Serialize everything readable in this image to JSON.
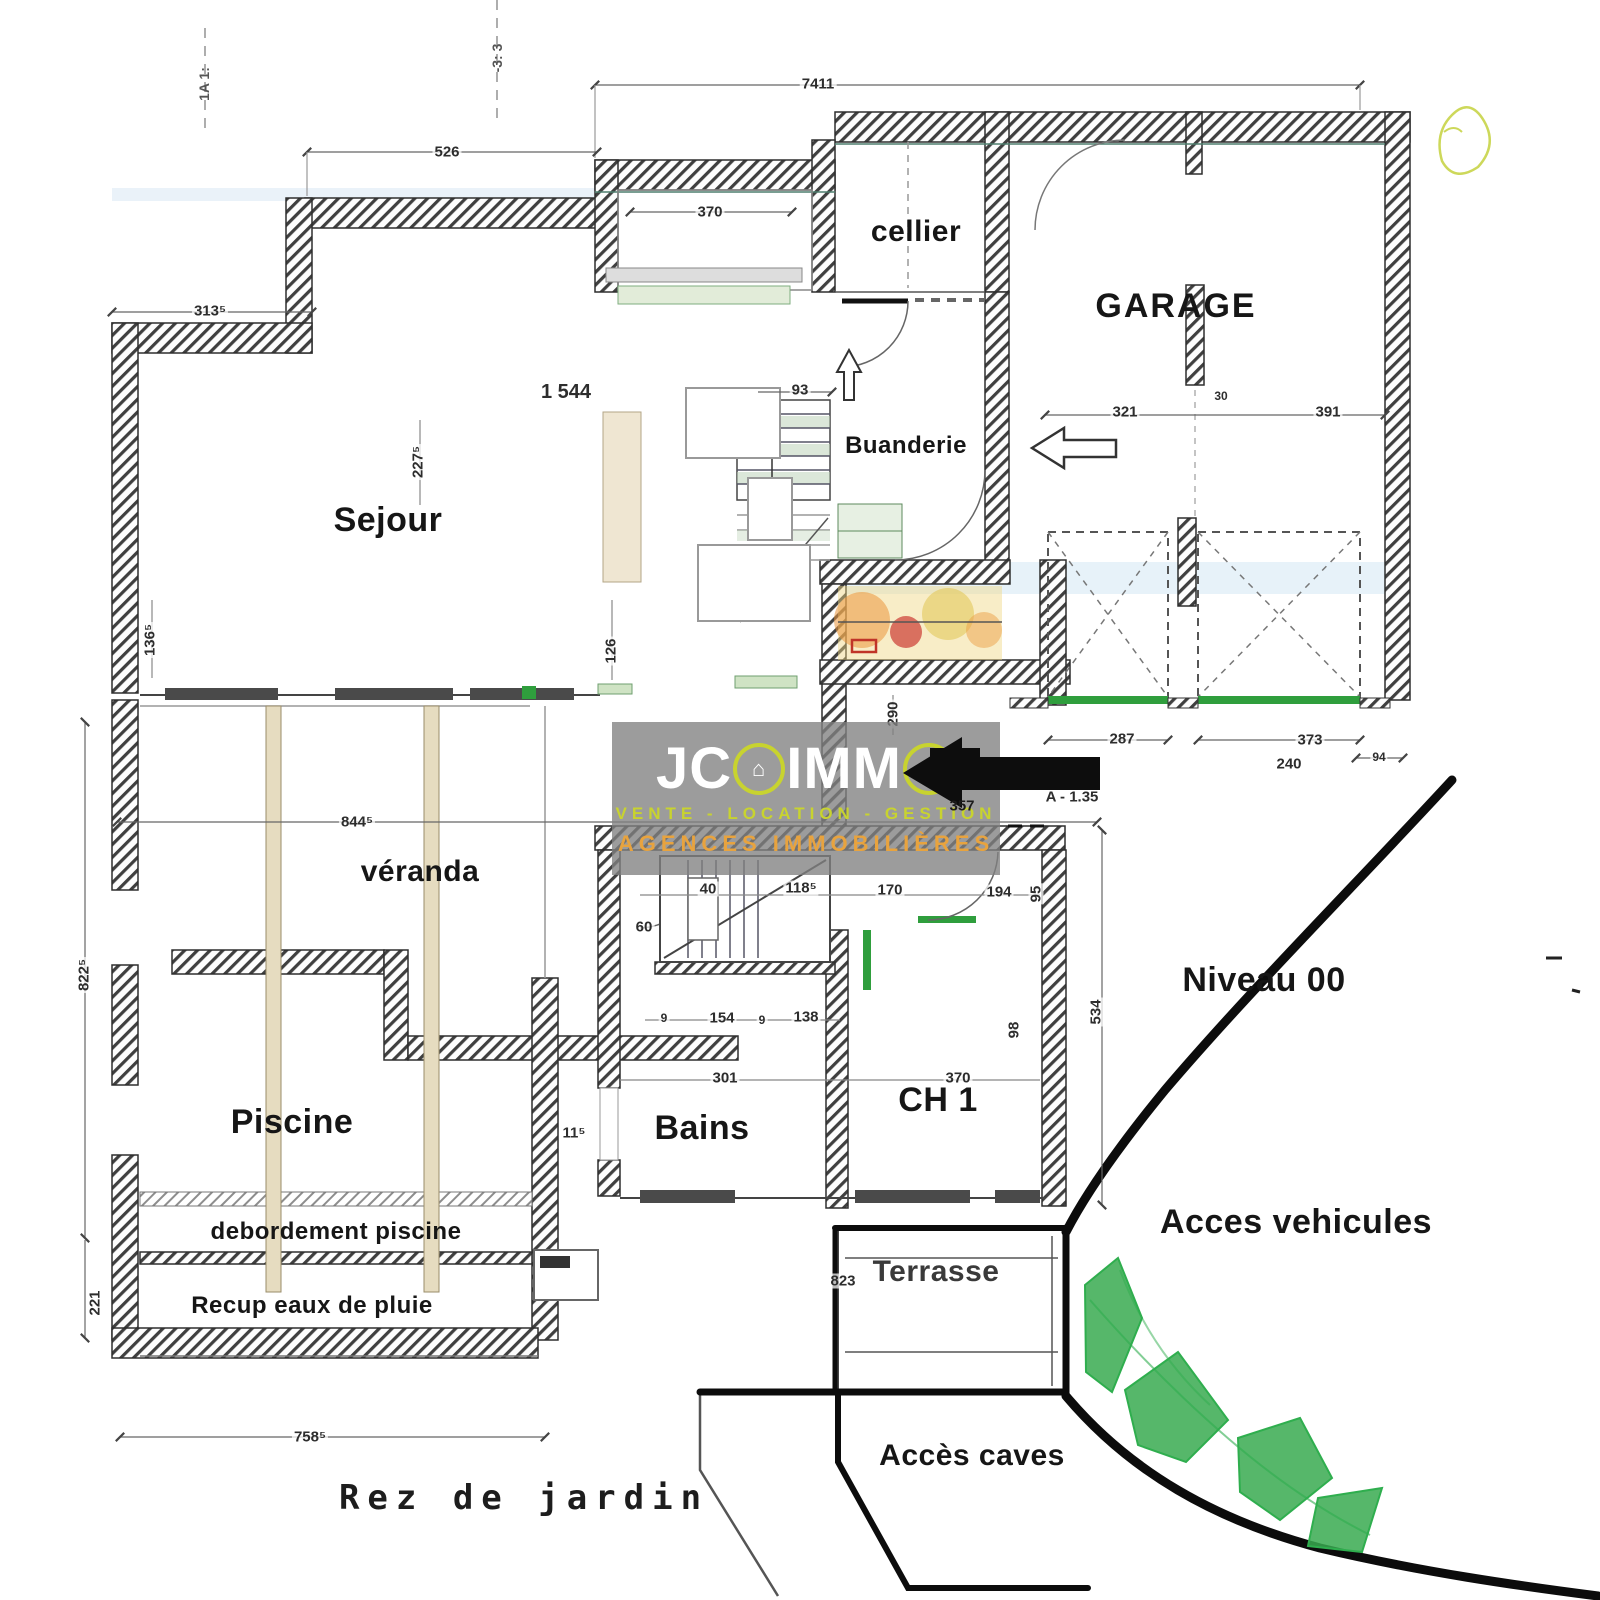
{
  "floor": {
    "label": "Rez de jardin"
  },
  "watermark": {
    "jc": "JC",
    "g_house": "⌂",
    "imm": "IMM",
    "o_house": "⌂",
    "tagline": "VENTE - LOCATION - GESTION",
    "subtitle": "AGENCES IMMOBILIÈRES",
    "colors": {
      "box": "#808080",
      "brand": "#ffffff",
      "accent": "#c8d32f",
      "subtitle": "#e8a33e"
    }
  },
  "rooms": {
    "sejour": "Sejour",
    "cellier": "cellier",
    "garage": "GARAGE",
    "buanderie": "Buanderie",
    "veranda": "véranda",
    "piscine": "Piscine",
    "debordement": "debordement piscine",
    "recup": "Recup eaux de pluie",
    "bains": "Bains",
    "ch1": "CH 1",
    "terrasse": "Terrasse",
    "niveau": "Niveau 00",
    "acces_vehicules": "Acces vehicules",
    "acces_caves": "Accès caves"
  },
  "dims": {
    "top": "7411",
    "w526": "526",
    "w3135": "313⁵",
    "w370": "370",
    "w1544": "1 544",
    "w93": "93",
    "v126": "126",
    "v1365": "136⁵",
    "v2275": "227⁵",
    "w8445": "844⁵",
    "v8225": "822⁵",
    "v221": "221",
    "w7585": "758⁵",
    "w115": "11⁵",
    "w40": "40",
    "w60": "60",
    "w1185": "118⁵",
    "w170": "170",
    "w194": "194",
    "w9a": "9",
    "w154": "154",
    "w9b": "9",
    "w138": "138",
    "w301": "301",
    "w370b": "370",
    "v98": "98",
    "v95": "95",
    "v534": "534",
    "a135": "A - 1.35",
    "v290": "290",
    "w357": "357",
    "v823": "823",
    "w321": "321",
    "w30": "30",
    "w391": "391",
    "w287": "287",
    "w373": "373",
    "w240": "240",
    "w94": "94"
  },
  "axes": {
    "a1": "1A 1:",
    "a2": "-3: 3"
  },
  "colors": {
    "wall": "#3f3f3f",
    "sill_green": "#2f9e3d",
    "vegetation": "#2fae4e",
    "marker_orange": "#e0883c",
    "marker_red": "#c03428",
    "annotation_black": "#0d0d0d"
  }
}
